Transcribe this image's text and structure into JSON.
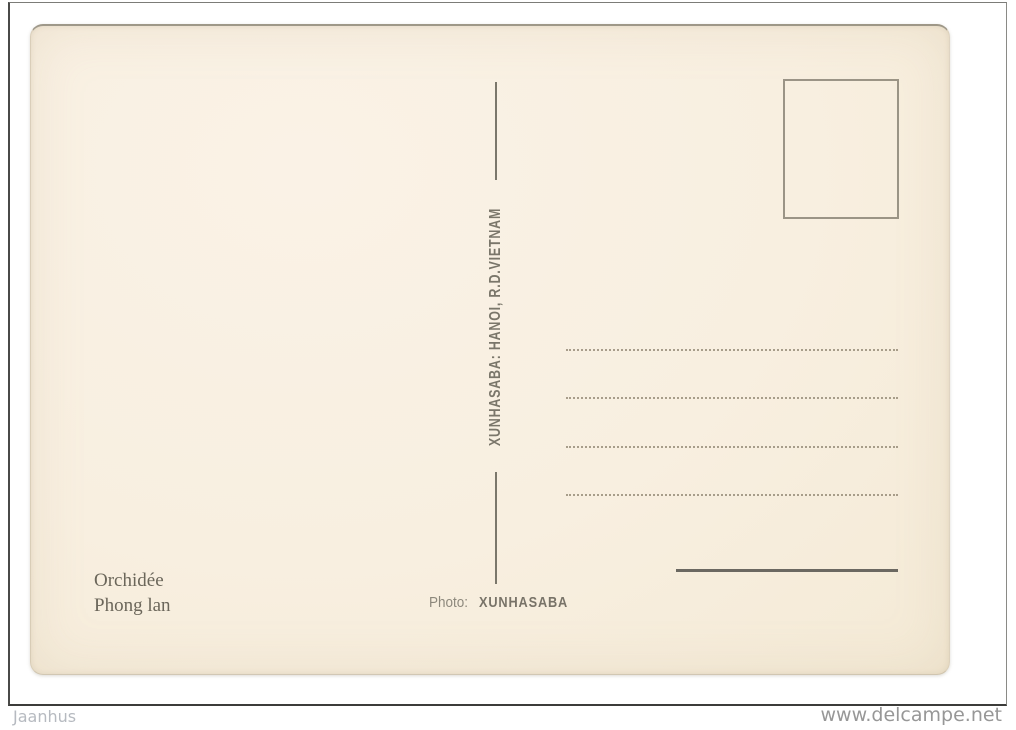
{
  "postcard": {
    "publisher_line": "XUNHASABA: HANOI, R.D.VIETNAM",
    "caption_french": "Orchidée",
    "caption_vietnamese": "Phong lan",
    "photo_label": "Photo:",
    "photo_credit": "XUNHASABA"
  },
  "watermarks": {
    "seller": "Jaanhus",
    "site": "www.delcampe.net"
  },
  "colors": {
    "card_background": "#f8efe0",
    "ink": "#76715f",
    "divider_line": "#7b776b",
    "dotted_line": "#8c826e",
    "thick_line": "#6b6861",
    "frame_border": "#4a4a48",
    "watermark_left": "#b6bac0",
    "watermark_right": "#979797"
  }
}
